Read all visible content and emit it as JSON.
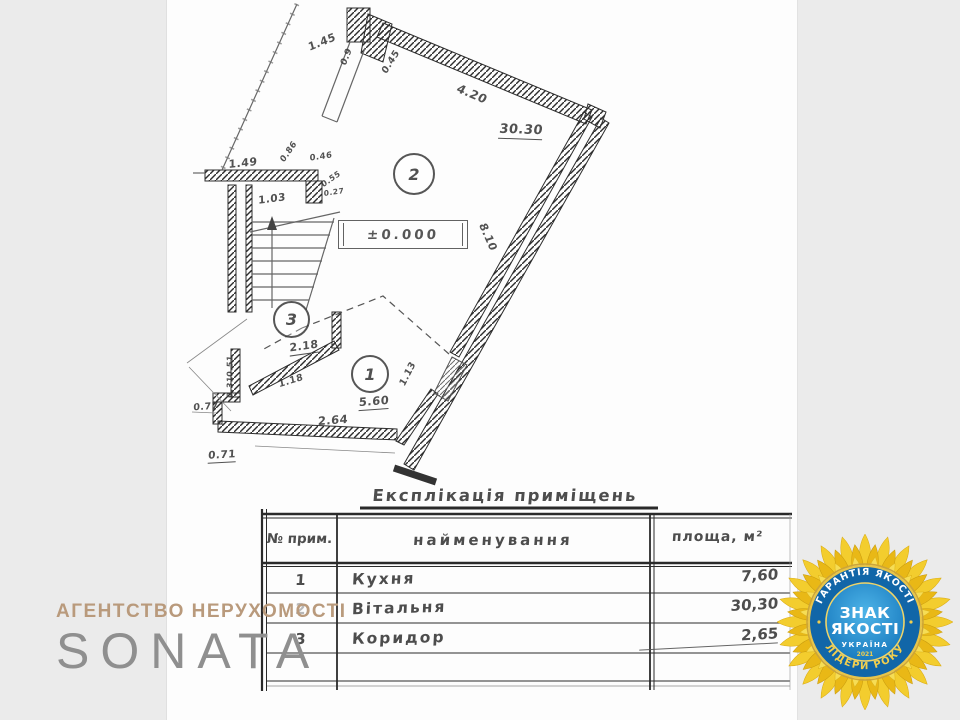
{
  "brand": {
    "agency_line": "АГЕНТСТВО НЕРУХОМОСТІ",
    "name": "SONATA"
  },
  "badge": {
    "arc_top": "ГАРАНТІЯ ЯКОСТІ",
    "arc_bottom": "ЛІДЕРИ РОКУ",
    "center_line1": "ЗНАК",
    "center_line2": "ЯКОСТІ",
    "country": "УКРАЇНА",
    "year": "2021",
    "colors": {
      "petal": "#f0c321",
      "ring_blue": "#1166a8",
      "center_blue": "#2a97d4",
      "gold_text": "#f2cf4e"
    }
  },
  "plan": {
    "room_numbers": [
      "1",
      "2",
      "3"
    ],
    "elevation_mark": "±0.000",
    "dimensions": [
      "1.45",
      "0.9",
      "0.45",
      "4.20",
      "30.30",
      "8.10",
      "1.49",
      "0.86",
      "0.46",
      "0.55",
      "0.27",
      "1.03",
      "2.18",
      "1.18",
      "0.51",
      "0.31",
      "0.77",
      "0.71",
      "2.64",
      "5.60",
      "1.13"
    ]
  },
  "table": {
    "title": "Експлікація приміщень",
    "columns": [
      "№ прим.",
      "найменування",
      "площа, м²"
    ],
    "rows": [
      {
        "num": "1",
        "name": "Кухня",
        "area": "7,60"
      },
      {
        "num": "2",
        "name": "Вітальня",
        "area": "30,30"
      },
      {
        "num": "3",
        "name": "Коридор",
        "area": "2,65"
      }
    ]
  }
}
